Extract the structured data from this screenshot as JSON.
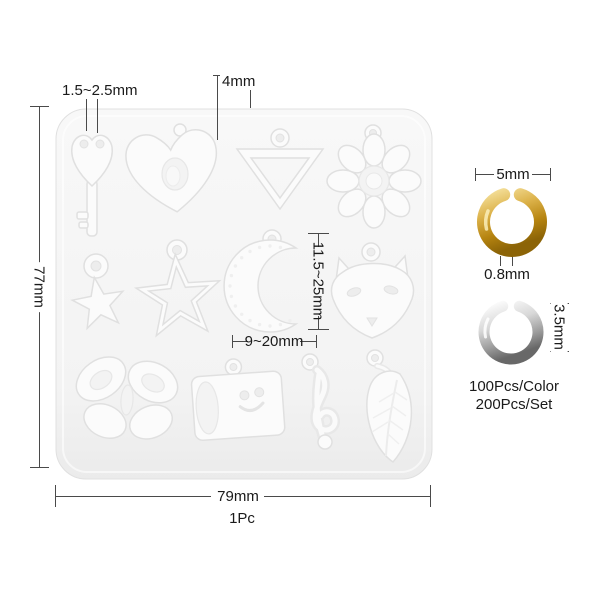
{
  "product": {
    "type": "silicone charm mold with open jump rings",
    "mold": {
      "color_hex": "#f4f4f4",
      "cavities": [
        "key",
        "heart",
        "inverted-triangle",
        "flower",
        "small-star",
        "big-star",
        "crescent-moon",
        "fox-head",
        "butterfly",
        "cylinder-tag",
        "treble-clef",
        "leaf"
      ]
    },
    "gold_ring_color_hex": "#c9951d",
    "silver_ring_color_hex": "#9a9a9a"
  },
  "annotations": {
    "key_holes": "1.5~2.5mm",
    "heart_hole": "4mm",
    "mold_height": "77mm",
    "charm_height_range": "11.5~25mm",
    "charm_width_range": "9~20mm",
    "mold_width": "79mm",
    "mold_quantity": "1Pc",
    "gold_ring_diameter": "5mm",
    "gold_ring_wire": "0.8mm",
    "silver_ring_diameter": "3.5mm",
    "pcs_per_color": "100Pcs/Color",
    "pcs_per_set": "200Pcs/Set"
  }
}
